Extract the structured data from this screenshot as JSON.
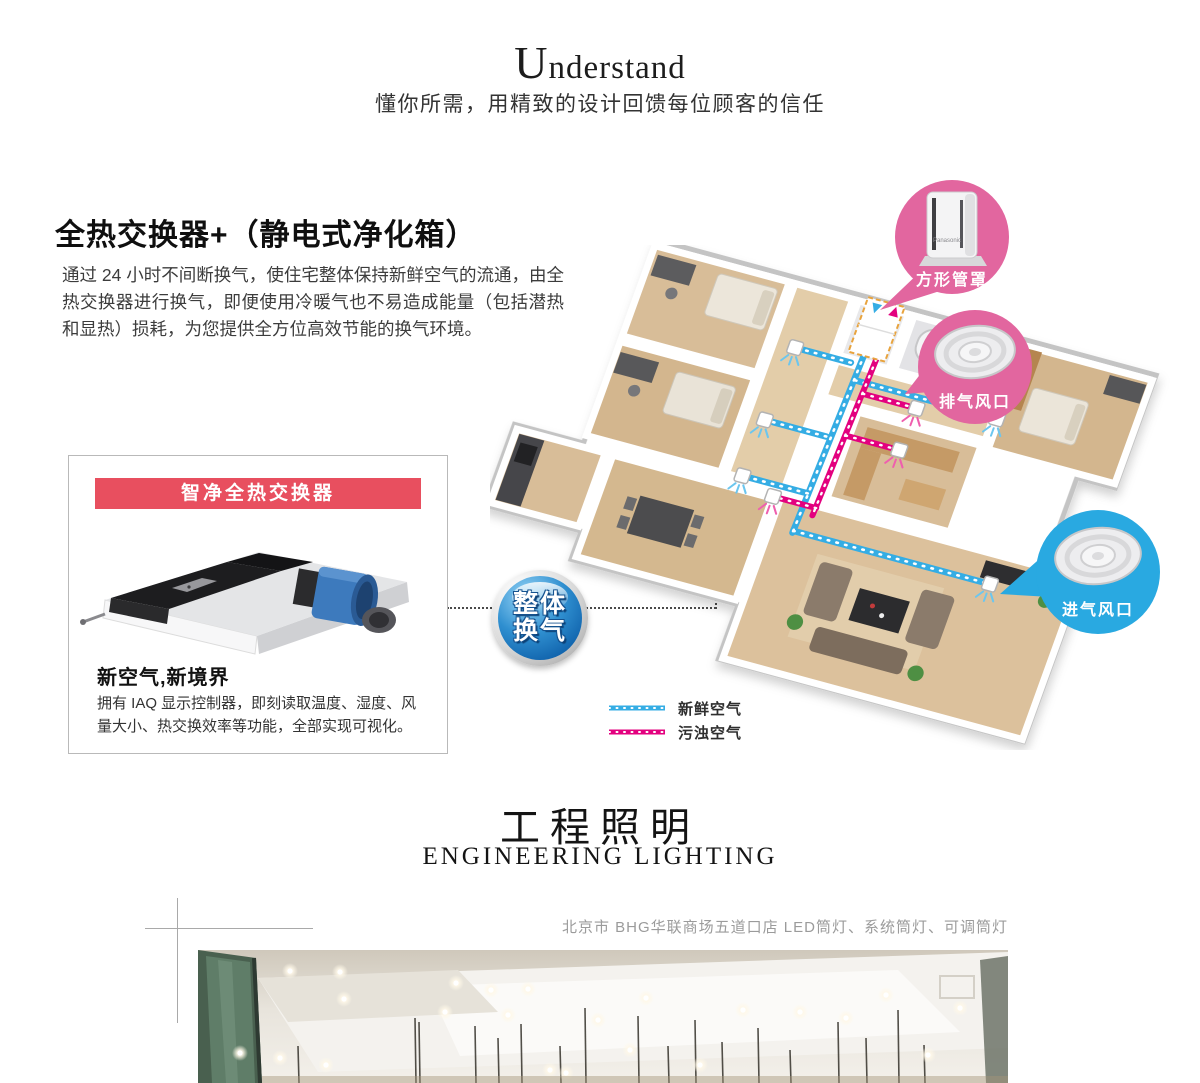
{
  "header": {
    "title": "Understand",
    "subtitle": "懂你所需，用精致的设计回馈每位顾客的信任"
  },
  "ventilation": {
    "heading": "全热交换器+（静电式净化箱）",
    "body": "通过 24 小时不间断换气，使住宅整体保持新鲜空气的流通，由全热交换器进行换气，即便使用冷暖气也不易造成能量（包括潜热和显热）损耗，为您提供全方位高效节能的换气环境。",
    "card": {
      "banner": "智净全热交换器",
      "subheading": "新空气,新境界",
      "description": "拥有 IAQ 显示控制器，即刻读取温度、湿度、风量大小、热交换效率等功能，全部实现可视化。"
    },
    "badge": {
      "line1": "整体",
      "line2": "换气"
    },
    "callouts": {
      "square_duct_cover": "方形管罩",
      "exhaust_vent": "排气风口",
      "intake_vent": "进气风口"
    },
    "product_brand": "Panasonic",
    "legend": {
      "fresh": "新鲜空气",
      "polluted": "污浊空气"
    }
  },
  "lighting": {
    "title_cn": "工程照明",
    "title_en": "ENGINEERING LIGHTING",
    "caption": "北京市 BHG华联商场五道口店 LED筒灯、系统筒灯、可调筒灯"
  },
  "colors": {
    "accent_red": "#e84f5f",
    "callout_pink": "#e2669f",
    "callout_blue": "#29a9e1",
    "duct_fresh": "#35ade4",
    "duct_polluted": "#e3017f",
    "badge_blue": "#0d5ea8"
  }
}
